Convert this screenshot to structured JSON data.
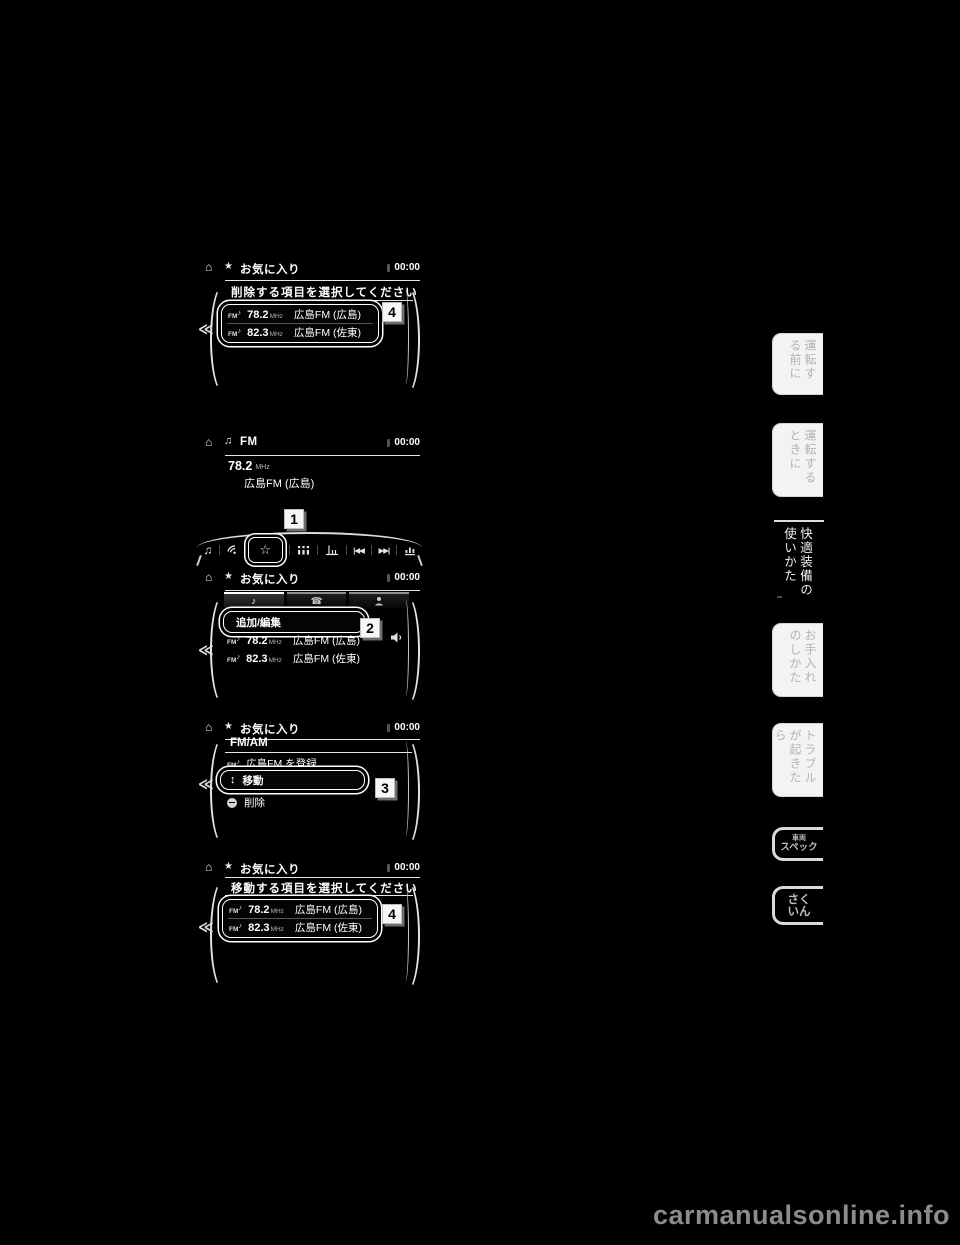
{
  "icons": {
    "home": "⌂",
    "star": "★",
    "star_outline": "☆",
    "note": "♪",
    "notes": "♫",
    "phone": "☎",
    "back": "≪",
    "seek_back": "|◀◀",
    "seek_forward": "▶▶|",
    "move_updown": "↕",
    "fm": "FM"
  },
  "screen_delete": {
    "title": "お気に入り",
    "clock": "00:00",
    "prompt": "削除する項目を選択してください",
    "items": [
      {
        "freq": "78.2",
        "unit": "MHz",
        "name": "広島FM (広島)"
      },
      {
        "freq": "82.3",
        "unit": "MHz",
        "name": "広島FM (佐東)"
      }
    ],
    "badge": "4"
  },
  "screen_fm": {
    "title": "FM",
    "clock": "00:00",
    "freq": "78.2",
    "unit": "MHz",
    "station": "広島FM (広島)"
  },
  "toolbar": {
    "badge": "1"
  },
  "screen_favorites": {
    "title": "お気に入り",
    "clock": "00:00",
    "add_edit_button": "追加/編集",
    "items": [
      {
        "freq": "78.2",
        "unit": "MHz",
        "name": "広島FM (広島)"
      },
      {
        "freq": "82.3",
        "unit": "MHz",
        "name": "広島FM (佐東)"
      }
    ],
    "badge": "2"
  },
  "screen_menu": {
    "title": "お気に入り",
    "clock": "00:00",
    "band": "FM/AM",
    "register_item": "広島FM を登録",
    "move_item": "移動",
    "delete_item": "削除",
    "badge": "3"
  },
  "screen_move": {
    "title": "お気に入り",
    "clock": "00:00",
    "prompt": "移動する項目を選択してください",
    "items": [
      {
        "freq": "78.2",
        "unit": "MHz",
        "name": "広島FM (広島)"
      },
      {
        "freq": "82.3",
        "unit": "MHz",
        "name": "広島FM (佐東)"
      }
    ],
    "badge": "4"
  },
  "sidebar": {
    "tabs": [
      {
        "label": "運転する前に"
      },
      {
        "label": "運転するときに"
      },
      {
        "label": "快適装備の使いかた"
      },
      {
        "label": "お手入れのしかた"
      },
      {
        "label": "トラブルが起きたら"
      }
    ],
    "spec_tab": {
      "line1": "車両",
      "line2": "スペック"
    },
    "index_tab": {
      "line1": "さく",
      "line2": "いん"
    }
  },
  "watermark": "carmanualsonline.info"
}
